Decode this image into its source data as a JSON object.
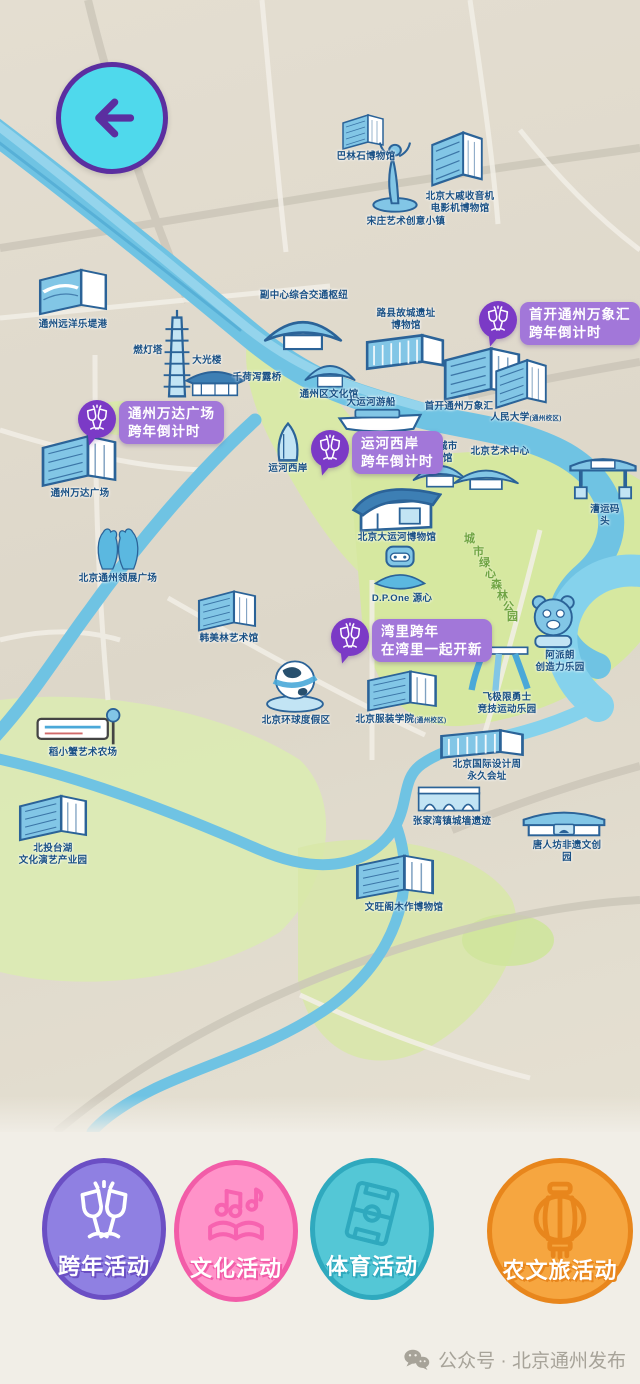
{
  "colors": {
    "map_bg": "#DFD9CC",
    "green": "#D8E8A4",
    "water": "#6FC3E3",
    "label_blue": "#195084",
    "badge_rect": "#A277D9",
    "badge_circle": "#7B3AC6",
    "back_bg": "#4FD9EC",
    "back_arrow": "#5B2EA0",
    "bottom_bg": "#F1EEE7"
  },
  "back_button": {
    "icon": "back-arrow-icon"
  },
  "map": {
    "forest_label": {
      "text": "城市绿心森林公园",
      "positions": [
        [
          464,
          530
        ],
        [
          473,
          543
        ],
        [
          479,
          554
        ],
        [
          485,
          565
        ],
        [
          491,
          576
        ],
        [
          497,
          587
        ],
        [
          503,
          598
        ],
        [
          507,
          608
        ]
      ]
    },
    "badges": [
      {
        "name": "badge-wanxianghui-countdown",
        "lines": "首开通州万象汇\n跨年倒计时",
        "x": 479,
        "y": 301,
        "icon": "champagne-icon"
      },
      {
        "name": "badge-wanda-countdown",
        "lines": "通州万达广场\n跨年倒计时",
        "x": 78,
        "y": 400,
        "icon": "champagne-icon"
      },
      {
        "name": "badge-canal-west-countdown",
        "lines": "运河西岸\n跨年倒计时",
        "x": 311,
        "y": 430,
        "icon": "champagne-icon"
      },
      {
        "name": "badge-wanli-newyear",
        "lines": "湾里跨年\n在湾里一起开新",
        "x": 331,
        "y": 618,
        "icon": "champagne-icon"
      }
    ],
    "landmarks": [
      {
        "name": "balinshi-museum",
        "label": "巴林石博物馆",
        "x": 366,
        "y": 151,
        "icon": "building",
        "ix": 338,
        "iy": 112,
        "iw": 50,
        "ih": 40
      },
      {
        "name": "radio-film-museum",
        "label": "北京大戚收音机\n电影机博物馆",
        "x": 460,
        "y": 191,
        "icon": "building",
        "ix": 426,
        "iy": 128,
        "iw": 62,
        "ih": 62
      },
      {
        "name": "songzhuang-art-town",
        "label": "宋庄艺术创意小镇",
        "x": 406,
        "y": 216,
        "icon": "statue",
        "ix": 370,
        "iy": 138,
        "iw": 50,
        "ih": 76
      },
      {
        "name": "ocean-ledigang",
        "label": "通州远洋乐堤港",
        "x": 73,
        "y": 319,
        "icon": "wavebuilding",
        "ix": 32,
        "iy": 266,
        "iw": 82,
        "ih": 52
      },
      {
        "name": "subcenter-transport-hub",
        "label": "副中心综合交通枢纽",
        "x": 304,
        "y": 290,
        "icon": "tent",
        "ix": 260,
        "iy": 304,
        "iw": 86,
        "ih": 52
      },
      {
        "name": "luxian-ruins-museum",
        "label": "路县故城遗址\n博物馆",
        "x": 406,
        "y": 308,
        "icon": "longbox",
        "ix": 362,
        "iy": 330,
        "iw": 86,
        "ih": 44
      },
      {
        "name": "randeng-pagoda",
        "label": "燃灯塔",
        "x": 148,
        "y": 345,
        "icon": "pagoda",
        "ix": 161,
        "iy": 308,
        "iw": 32,
        "ih": 96
      },
      {
        "name": "daguang-tower",
        "label": "大光楼",
        "x": 207,
        "y": 355,
        "icon": "pavilion",
        "ix": 184,
        "iy": 362,
        "iw": 62,
        "ih": 40
      },
      {
        "name": "qianhexielu-bridge",
        "label": "千荷泻露桥",
        "x": 257,
        "y": 372
      },
      {
        "name": "tongzhou-culture-center",
        "label": "通州区文化馆",
        "x": 329,
        "y": 389,
        "icon": "tent",
        "ix": 302,
        "iy": 352,
        "iw": 56,
        "ih": 40
      },
      {
        "name": "grand-canal-cruise",
        "label": "大运河游船",
        "x": 371,
        "y": 397,
        "icon": "boat",
        "ix": 336,
        "iy": 408,
        "iw": 88,
        "ih": 26
      },
      {
        "name": "shoukai-wanxianghui",
        "label": "首开通州万象汇",
        "x": 459,
        "y": 401,
        "icon": "building",
        "ix": 436,
        "iy": 344,
        "iw": 92,
        "ih": 60
      },
      {
        "name": "renmin-university",
        "label": "人民大学",
        "suffix": "(通州校区)",
        "x": 526,
        "y": 412,
        "icon": "building",
        "ix": 490,
        "iy": 356,
        "iw": 62,
        "ih": 56
      },
      {
        "name": "wanda-plaza",
        "label": "通州万达广场",
        "x": 80,
        "y": 488,
        "icon": "building",
        "ix": 34,
        "iy": 432,
        "iw": 90,
        "ih": 58
      },
      {
        "name": "canal-west-bank",
        "label": "运河西岸",
        "x": 288,
        "y": 463,
        "icon": "sail",
        "ix": 262,
        "iy": 420,
        "iw": 52,
        "ih": 44
      },
      {
        "name": "beijing-city-library",
        "label": "北京城市\n图书馆",
        "x": 438,
        "y": 441,
        "icon": "tent",
        "ix": 410,
        "iy": 452,
        "iw": 60,
        "ih": 40
      },
      {
        "name": "beijing-arts-center",
        "label": "北京艺术中心",
        "x": 500,
        "y": 446,
        "icon": "tent",
        "ix": 450,
        "iy": 458,
        "iw": 72,
        "ih": 36
      },
      {
        "name": "caoyun-wharf",
        "label": "漕运码头",
        "x": 605,
        "y": 504,
        "icon": "gate",
        "ix": 566,
        "iy": 448,
        "iw": 74,
        "ih": 56
      },
      {
        "name": "link-plaza",
        "label": "北京通州领展广场",
        "x": 118,
        "y": 573,
        "icon": "hands",
        "ix": 92,
        "iy": 524,
        "iw": 52,
        "ih": 50
      },
      {
        "name": "hanmeilin-art-museum",
        "label": "韩美林艺术馆",
        "x": 229,
        "y": 633,
        "icon": "building",
        "ix": 192,
        "iy": 588,
        "iw": 70,
        "ih": 46
      },
      {
        "name": "grand-canal-museum",
        "label": "北京大运河博物馆",
        "x": 397,
        "y": 532,
        "icon": "museum",
        "ix": 350,
        "iy": 474,
        "iw": 92,
        "ih": 60
      },
      {
        "name": "dpone-yuanxin",
        "label": "D.P.One 源心",
        "x": 402,
        "y": 593,
        "icon": "robot",
        "ix": 366,
        "iy": 544,
        "iw": 68,
        "ih": 50
      },
      {
        "name": "apailang-creativity-park",
        "label": "阿派朗\n创造力乐园",
        "x": 560,
        "y": 650,
        "icon": "bear",
        "ix": 520,
        "iy": 590,
        "iw": 64,
        "ih": 62
      },
      {
        "name": "feijixian-warrior-sports-park",
        "label": "飞极限勇士\n竞技运动乐园",
        "x": 507,
        "y": 692,
        "icon": "slide",
        "ix": 466,
        "iy": 634,
        "iw": 70,
        "ih": 60
      },
      {
        "name": "universal-resort",
        "label": "北京环球度假区",
        "x": 296,
        "y": 715,
        "icon": "globe",
        "ix": 264,
        "iy": 656,
        "iw": 62,
        "ih": 60
      },
      {
        "name": "bift",
        "label": "北京服装学院",
        "suffix": "(通州校区)",
        "x": 401,
        "y": 714,
        "icon": "building",
        "ix": 360,
        "iy": 668,
        "iw": 84,
        "ih": 46
      },
      {
        "name": "design-week-site",
        "label": "北京国际设计周\n永久会址",
        "x": 487,
        "y": 759,
        "icon": "longbox",
        "ix": 436,
        "iy": 726,
        "iw": 92,
        "ih": 36
      },
      {
        "name": "daoxiaoxie-art-farm",
        "label": "稻小蟹艺术农场",
        "x": 83,
        "y": 747,
        "icon": "sign",
        "ix": 34,
        "iy": 708,
        "iw": 90,
        "ih": 40
      },
      {
        "name": "beitou-taihu-performing-arts-park",
        "label": "北投台湖\n文化演艺产业园",
        "x": 53,
        "y": 843,
        "icon": "building",
        "ix": 12,
        "iy": 792,
        "iw": 82,
        "ih": 52
      },
      {
        "name": "zhangjiawan-wall-ruins",
        "label": "张家湾镇城墙遗迹",
        "x": 452,
        "y": 816,
        "icon": "bridge",
        "ix": 416,
        "iy": 782,
        "iw": 66,
        "ih": 34
      },
      {
        "name": "tangrenfang-heritage-park",
        "label": "唐人坊非遗文创园",
        "x": 567,
        "y": 840,
        "icon": "pavilioncurve",
        "ix": 522,
        "iy": 804,
        "iw": 84,
        "ih": 36
      },
      {
        "name": "wenwangge-woodwork-museum",
        "label": "文旺阁木作博物馆",
        "x": 404,
        "y": 902,
        "icon": "building",
        "ix": 348,
        "iy": 852,
        "iw": 94,
        "ih": 50
      }
    ]
  },
  "categories": [
    {
      "name": "category-newyear",
      "label": "跨年活动",
      "fill": "#8F80E2",
      "ring": "#6B4FC4",
      "icon": "champagne-icon",
      "icon_color": "#FFFFFF",
      "left": 42,
      "top": 1158,
      "w": 124,
      "h": 142
    },
    {
      "name": "category-culture",
      "label": "文化活动",
      "fill": "#FF93C9",
      "ring": "#F25CA8",
      "icon": "music-book-icon",
      "icon_color": "#F763B0",
      "left": 174,
      "top": 1160,
      "w": 124,
      "h": 142
    },
    {
      "name": "category-sports",
      "label": "体育活动",
      "fill": "#54C7D6",
      "ring": "#2FA9BE",
      "icon": "sport-field-icon",
      "icon_color": "#2FA9BE",
      "left": 310,
      "top": 1158,
      "w": 124,
      "h": 142
    },
    {
      "name": "category-agritourism",
      "label": "农文旅活动",
      "fill": "#F6A640",
      "ring": "#E8861C",
      "icon": "lantern-icon",
      "icon_color": "#E8861C",
      "left": 487,
      "top": 1158,
      "w": 146,
      "h": 146
    }
  ],
  "watermark": {
    "icon": "wechat-icon",
    "label": "公众号 · 北京通州发布"
  }
}
